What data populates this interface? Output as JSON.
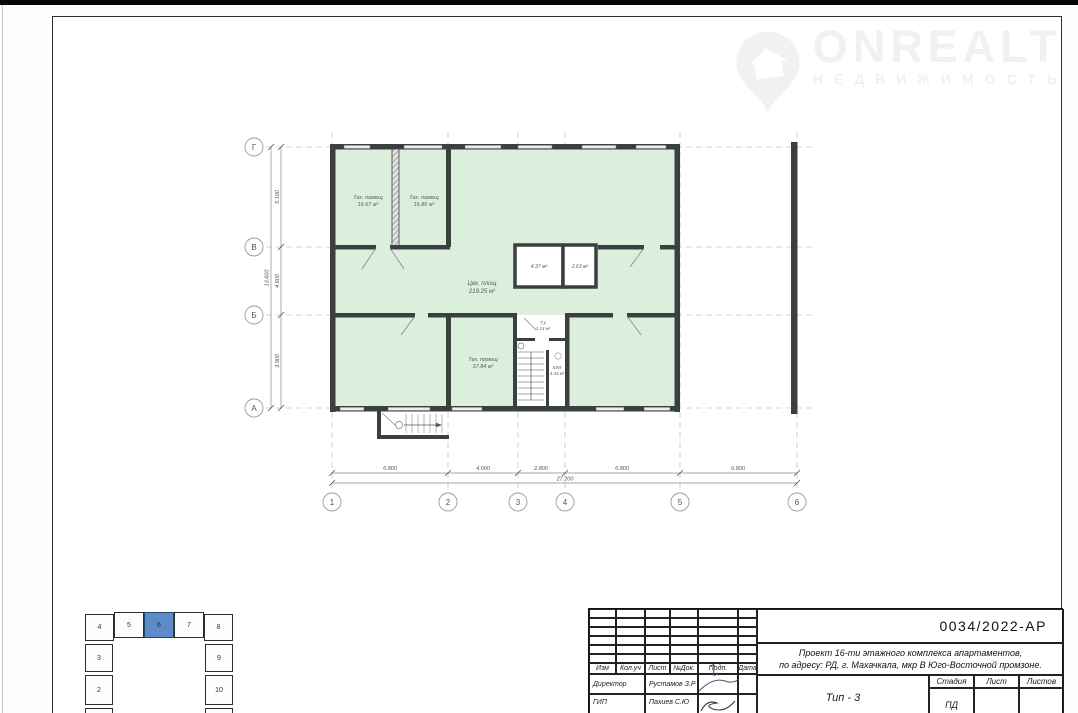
{
  "watermark": {
    "brand": "ONREALT",
    "tagline": "НЕДВИЖИМОСТЬ"
  },
  "plan": {
    "row_axes": [
      "Г",
      "В",
      "Б",
      "А"
    ],
    "col_axes": [
      "1",
      "2",
      "3",
      "4",
      "5",
      "6"
    ],
    "h_dims": [
      "6.800",
      "4.000",
      "2.800",
      "6.800",
      "6.800"
    ],
    "h_total": "27.200",
    "v_dims": [
      "5.100",
      "4.600",
      "3.900"
    ],
    "v_total": "13.600",
    "rooms": [
      {
        "label": "Тех. помещ",
        "area": "16.67 м²"
      },
      {
        "label": "Тех. помещ",
        "area": "16.86 м²"
      },
      {
        "label": "Цех. площ",
        "area": "219.25 м²"
      },
      {
        "label": "",
        "area": "4.37 м²"
      },
      {
        "label": "",
        "area": "2.63 м²"
      },
      {
        "label": "Т.у",
        "area": "1.14 м²"
      },
      {
        "label": "Тех. помещ",
        "area": "37.84 м²"
      },
      {
        "label": "КУИ",
        "area": "4.43 м²"
      }
    ]
  },
  "key_plan": {
    "blocks": [
      "1",
      "2",
      "3",
      "4",
      "5",
      "6",
      "7",
      "8",
      "9",
      "10",
      "11"
    ],
    "highlighted": "6",
    "highlight_color": "#5b8bc9"
  },
  "title_block": {
    "doc_code": "0034/2022-АР",
    "project_line1": "Проект 16-ти этажного комплекса апартаментов,",
    "project_line2": "по адресу: РД, г. Махачкала, мкр В Юго-Восточной промзоне.",
    "sheet_title": "Тип - 3",
    "stage_label": "Стадия",
    "sheet_label": "Лист",
    "sheets_label": "Листов",
    "stage_value": "ПД",
    "columns": [
      "Изм",
      "Кол.уч",
      "Лист",
      "№Док.",
      "Подп.",
      "Дата"
    ],
    "signers": [
      {
        "role": "Директор",
        "name": "Рустамов З.Р"
      },
      {
        "role": "ГИП",
        "name": "Пахиев С.Ю"
      }
    ]
  },
  "colors": {
    "wall": "#3a4040",
    "floor_fill": "#dcefdc",
    "highlight": "#5b8bc9"
  }
}
